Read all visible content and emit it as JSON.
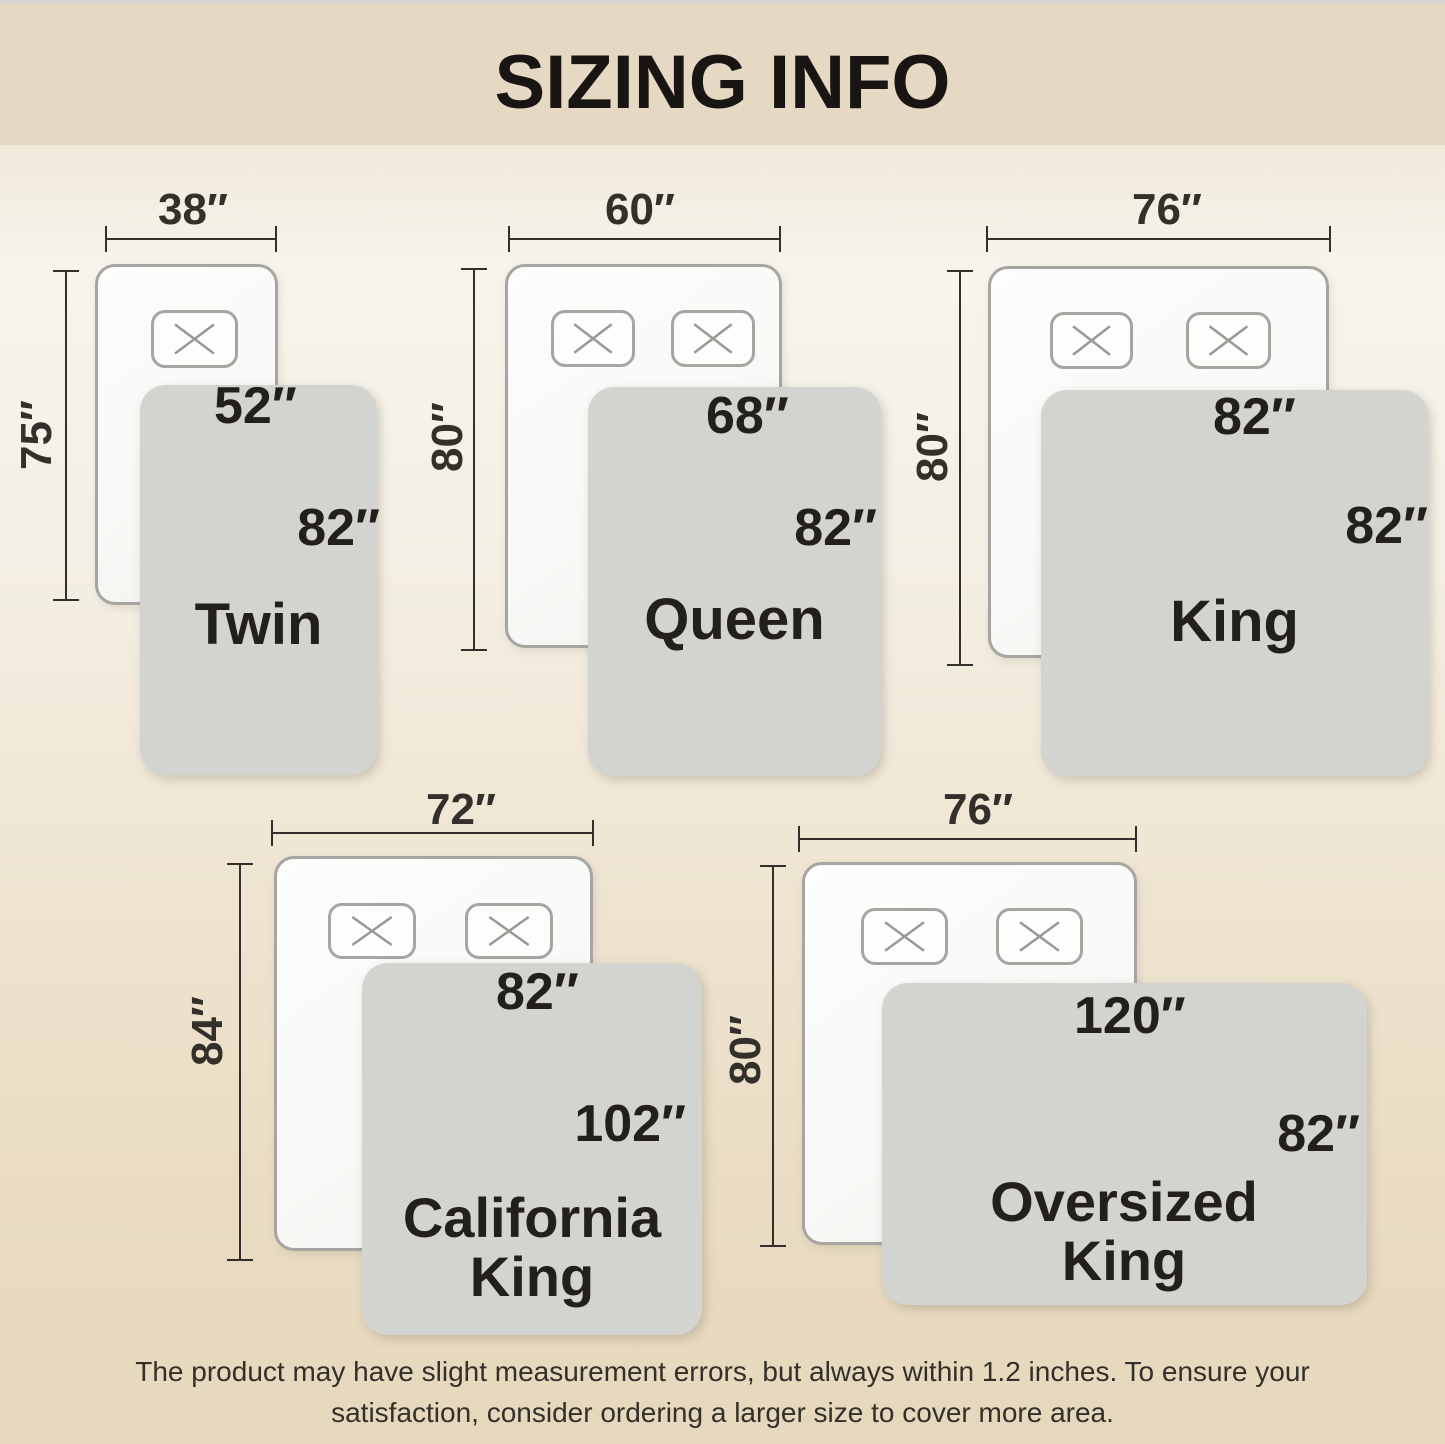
{
  "title": "SIZING INFO",
  "disclaimer": {
    "line1": "The product may have slight measurement errors, but always within 1.2 inches. To ensure your",
    "line2": "satisfaction, consider ordering a larger size to cover more area."
  },
  "sizes": [
    {
      "name": "Twin",
      "bed_width": "38″",
      "bed_length": "75″",
      "blanket_width": "52″",
      "blanket_length": "82″",
      "pillows": 1
    },
    {
      "name": "Queen",
      "bed_width": "60″",
      "bed_length": "80″",
      "blanket_width": "68″",
      "blanket_length": "82″",
      "pillows": 2
    },
    {
      "name": "King",
      "bed_width": "76″",
      "bed_length": "80″",
      "blanket_width": "82″",
      "blanket_length": "82″",
      "pillows": 2
    },
    {
      "name": "California King",
      "bed_width": "72″",
      "bed_length": "84″",
      "blanket_width": "82″",
      "blanket_length": "102″",
      "pillows": 2
    },
    {
      "name": "Oversized King",
      "bed_width": "76″",
      "bed_length": "80″",
      "blanket_width": "120″",
      "blanket_length": "82″",
      "pillows": 2
    }
  ],
  "colors": {
    "header": "#e5d9c3",
    "dim": "#33302b",
    "text": "#23201b",
    "bedborder": "#a7a5a2",
    "pillowborder": "#a7a5a2",
    "px": "#9a9895",
    "blanket": "#d3d3d0"
  }
}
